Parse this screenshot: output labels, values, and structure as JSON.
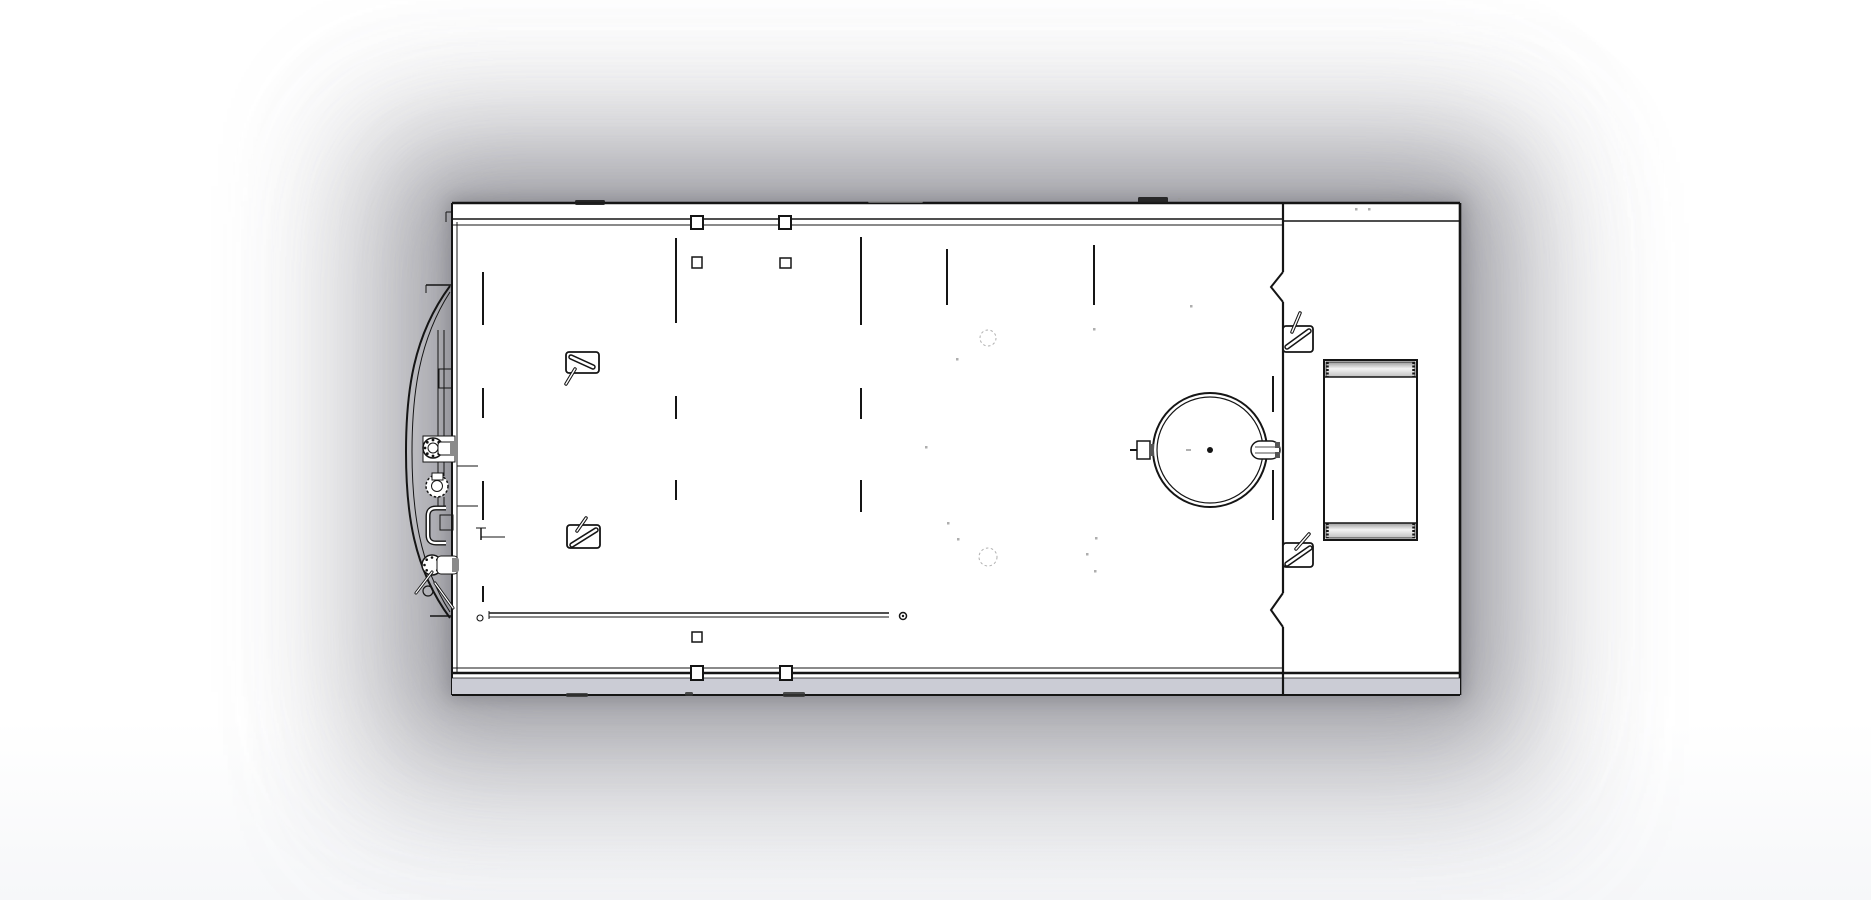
{
  "scene": {
    "description": "CAD top-view line drawing of a tank trailer deck assembly on a white sheet with soft gray shadow halo",
    "view_orientation": "top",
    "visible_text": []
  },
  "colors": {
    "background": "#ffffff",
    "paper": "#ffffff",
    "line": "#151515",
    "band_fill": "#cbccd5",
    "part_gray": "#c9c9c9",
    "dark_metal": "#8a8a8a",
    "smudge_dark": "#1d1d1d",
    "smudge_soft": "#999999",
    "ghost": "#b0b0b0",
    "speck": "#9a9a9a",
    "metal_grad_top": "#9a9a9a",
    "metal_grad_mid": "#f4f4f4",
    "metal_grad_bottom": "#c0c0c0"
  },
  "drawing": {
    "bounds": {
      "x": 452,
      "y": 203,
      "w": 1008,
      "h": 492
    },
    "divider_x": 1283,
    "seams": [
      {
        "x": 483,
        "segments": [
          [
            272,
            325
          ],
          [
            388,
            418
          ],
          [
            481,
            520
          ],
          [
            586,
            602
          ]
        ]
      },
      {
        "x": 676,
        "segments": [
          [
            238,
            323
          ],
          [
            396,
            419
          ],
          [
            480,
            500
          ]
        ]
      },
      {
        "x": 861,
        "segments": [
          [
            237,
            325
          ],
          [
            388,
            419
          ],
          [
            480,
            512
          ]
        ]
      },
      {
        "x": 947,
        "segments": [
          [
            249,
            305
          ]
        ]
      },
      {
        "x": 1094,
        "segments": [
          [
            245,
            305
          ]
        ]
      },
      {
        "x": 1273,
        "segments": [
          [
            376,
            412
          ],
          [
            470,
            520
          ]
        ]
      }
    ],
    "clips": [
      [
        691,
        216,
        12,
        13,
        2
      ],
      [
        779,
        216,
        12,
        13,
        2
      ],
      [
        692,
        257,
        10,
        11,
        1.5
      ],
      [
        780,
        258,
        11,
        10,
        1.5
      ],
      [
        692,
        632,
        10,
        10,
        1.5
      ],
      [
        691,
        666,
        12,
        14,
        2
      ],
      [
        780,
        666,
        12,
        14,
        2
      ]
    ],
    "chevrons": [
      {
        "x": 1283,
        "y1": 272,
        "ax": 1271,
        "ay": 287,
        "y2": 302
      },
      {
        "x": 1283,
        "y1": 593,
        "ax": 1271,
        "ay": 610,
        "y2": 627
      }
    ],
    "brackets": [
      {
        "x": 566,
        "y": 352,
        "w": 33,
        "h": 21,
        "bar": [
          571,
          357,
          593,
          367
        ],
        "rod": [
          575,
          369,
          566,
          384
        ]
      },
      {
        "x": 567,
        "y": 525,
        "w": 33,
        "h": 23,
        "bar": [
          572,
          545,
          596,
          530
        ],
        "rod": [
          577,
          531,
          586,
          518
        ]
      },
      {
        "x": 1283,
        "y": 326,
        "w": 30,
        "h": 26,
        "bar": [
          1287,
          347,
          1309,
          331
        ],
        "rod": [
          1292,
          332,
          1300,
          313
        ]
      },
      {
        "x": 1283,
        "y": 543,
        "w": 30,
        "h": 24,
        "bar": [
          1287,
          564,
          1310,
          548
        ],
        "rod": [
          1296,
          549,
          1309,
          534
        ]
      }
    ],
    "rail": {
      "x1": 489,
      "x2": 889,
      "y1": 613,
      "y2": 617,
      "end_circle": [
        903,
        616
      ],
      "start_circle": [
        480,
        618
      ]
    },
    "manhole": {
      "cx": 1210,
      "cy": 450,
      "r_outer": 57,
      "r_inner": 53
    },
    "toolbox": {
      "x": 1324,
      "y": 360,
      "w": 93,
      "h": 180,
      "band_h": 15,
      "band_inset": 2
    },
    "ghost_circles": [
      [
        988,
        338,
        8
      ],
      [
        988,
        557,
        9
      ]
    ],
    "specks": [
      [
        925,
        446
      ],
      [
        947,
        522
      ],
      [
        957,
        538
      ],
      [
        1095,
        537
      ],
      [
        1086,
        553
      ],
      [
        1094,
        570
      ],
      [
        1093,
        328
      ],
      [
        1190,
        305
      ],
      [
        1355,
        208
      ],
      [
        1368,
        208
      ],
      [
        1178,
        198
      ],
      [
        956,
        358
      ]
    ],
    "top_smudges": [
      {
        "r": [
          575,
          200,
          30,
          5
        ],
        "soft": false
      },
      {
        "r": [
          868,
          200,
          55,
          3
        ],
        "soft": true
      },
      {
        "r": [
          1138,
          197,
          30,
          6
        ],
        "soft": false
      }
    ],
    "bottom_smudges": [
      [
        566,
        693,
        22,
        4
      ],
      [
        685,
        692,
        8,
        4
      ],
      [
        783,
        692,
        22,
        5
      ]
    ]
  }
}
